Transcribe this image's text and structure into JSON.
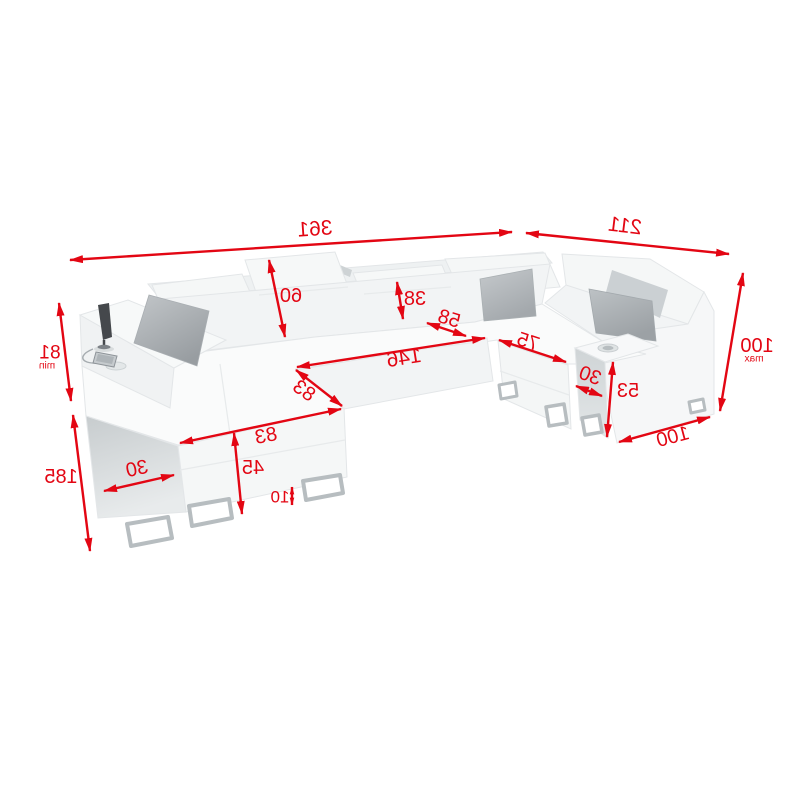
{
  "diagram": {
    "object": "corner-sofa-dimension-drawing",
    "accent_color": "#e30613",
    "text_mirrored": true,
    "dims": {
      "total_width": "361",
      "side_depth": "211",
      "height_max": "100",
      "height_max_suffix": "max",
      "armrest_height_min": "81",
      "armrest_height_min_suffix": "min",
      "chaise_length": "185",
      "chaise_side_width": "30",
      "seat_height": "45",
      "leg_height": "10",
      "bed_width_front": "83",
      "bed_width_inner": "83",
      "bed_length": "146",
      "corner_seat_depth": "58",
      "headrest_height_large": "60",
      "headrest_height_small": "38",
      "right_seat_width": "75",
      "right_armrest_width": "30",
      "right_armrest_height": "53",
      "right_section_width": "100"
    }
  }
}
